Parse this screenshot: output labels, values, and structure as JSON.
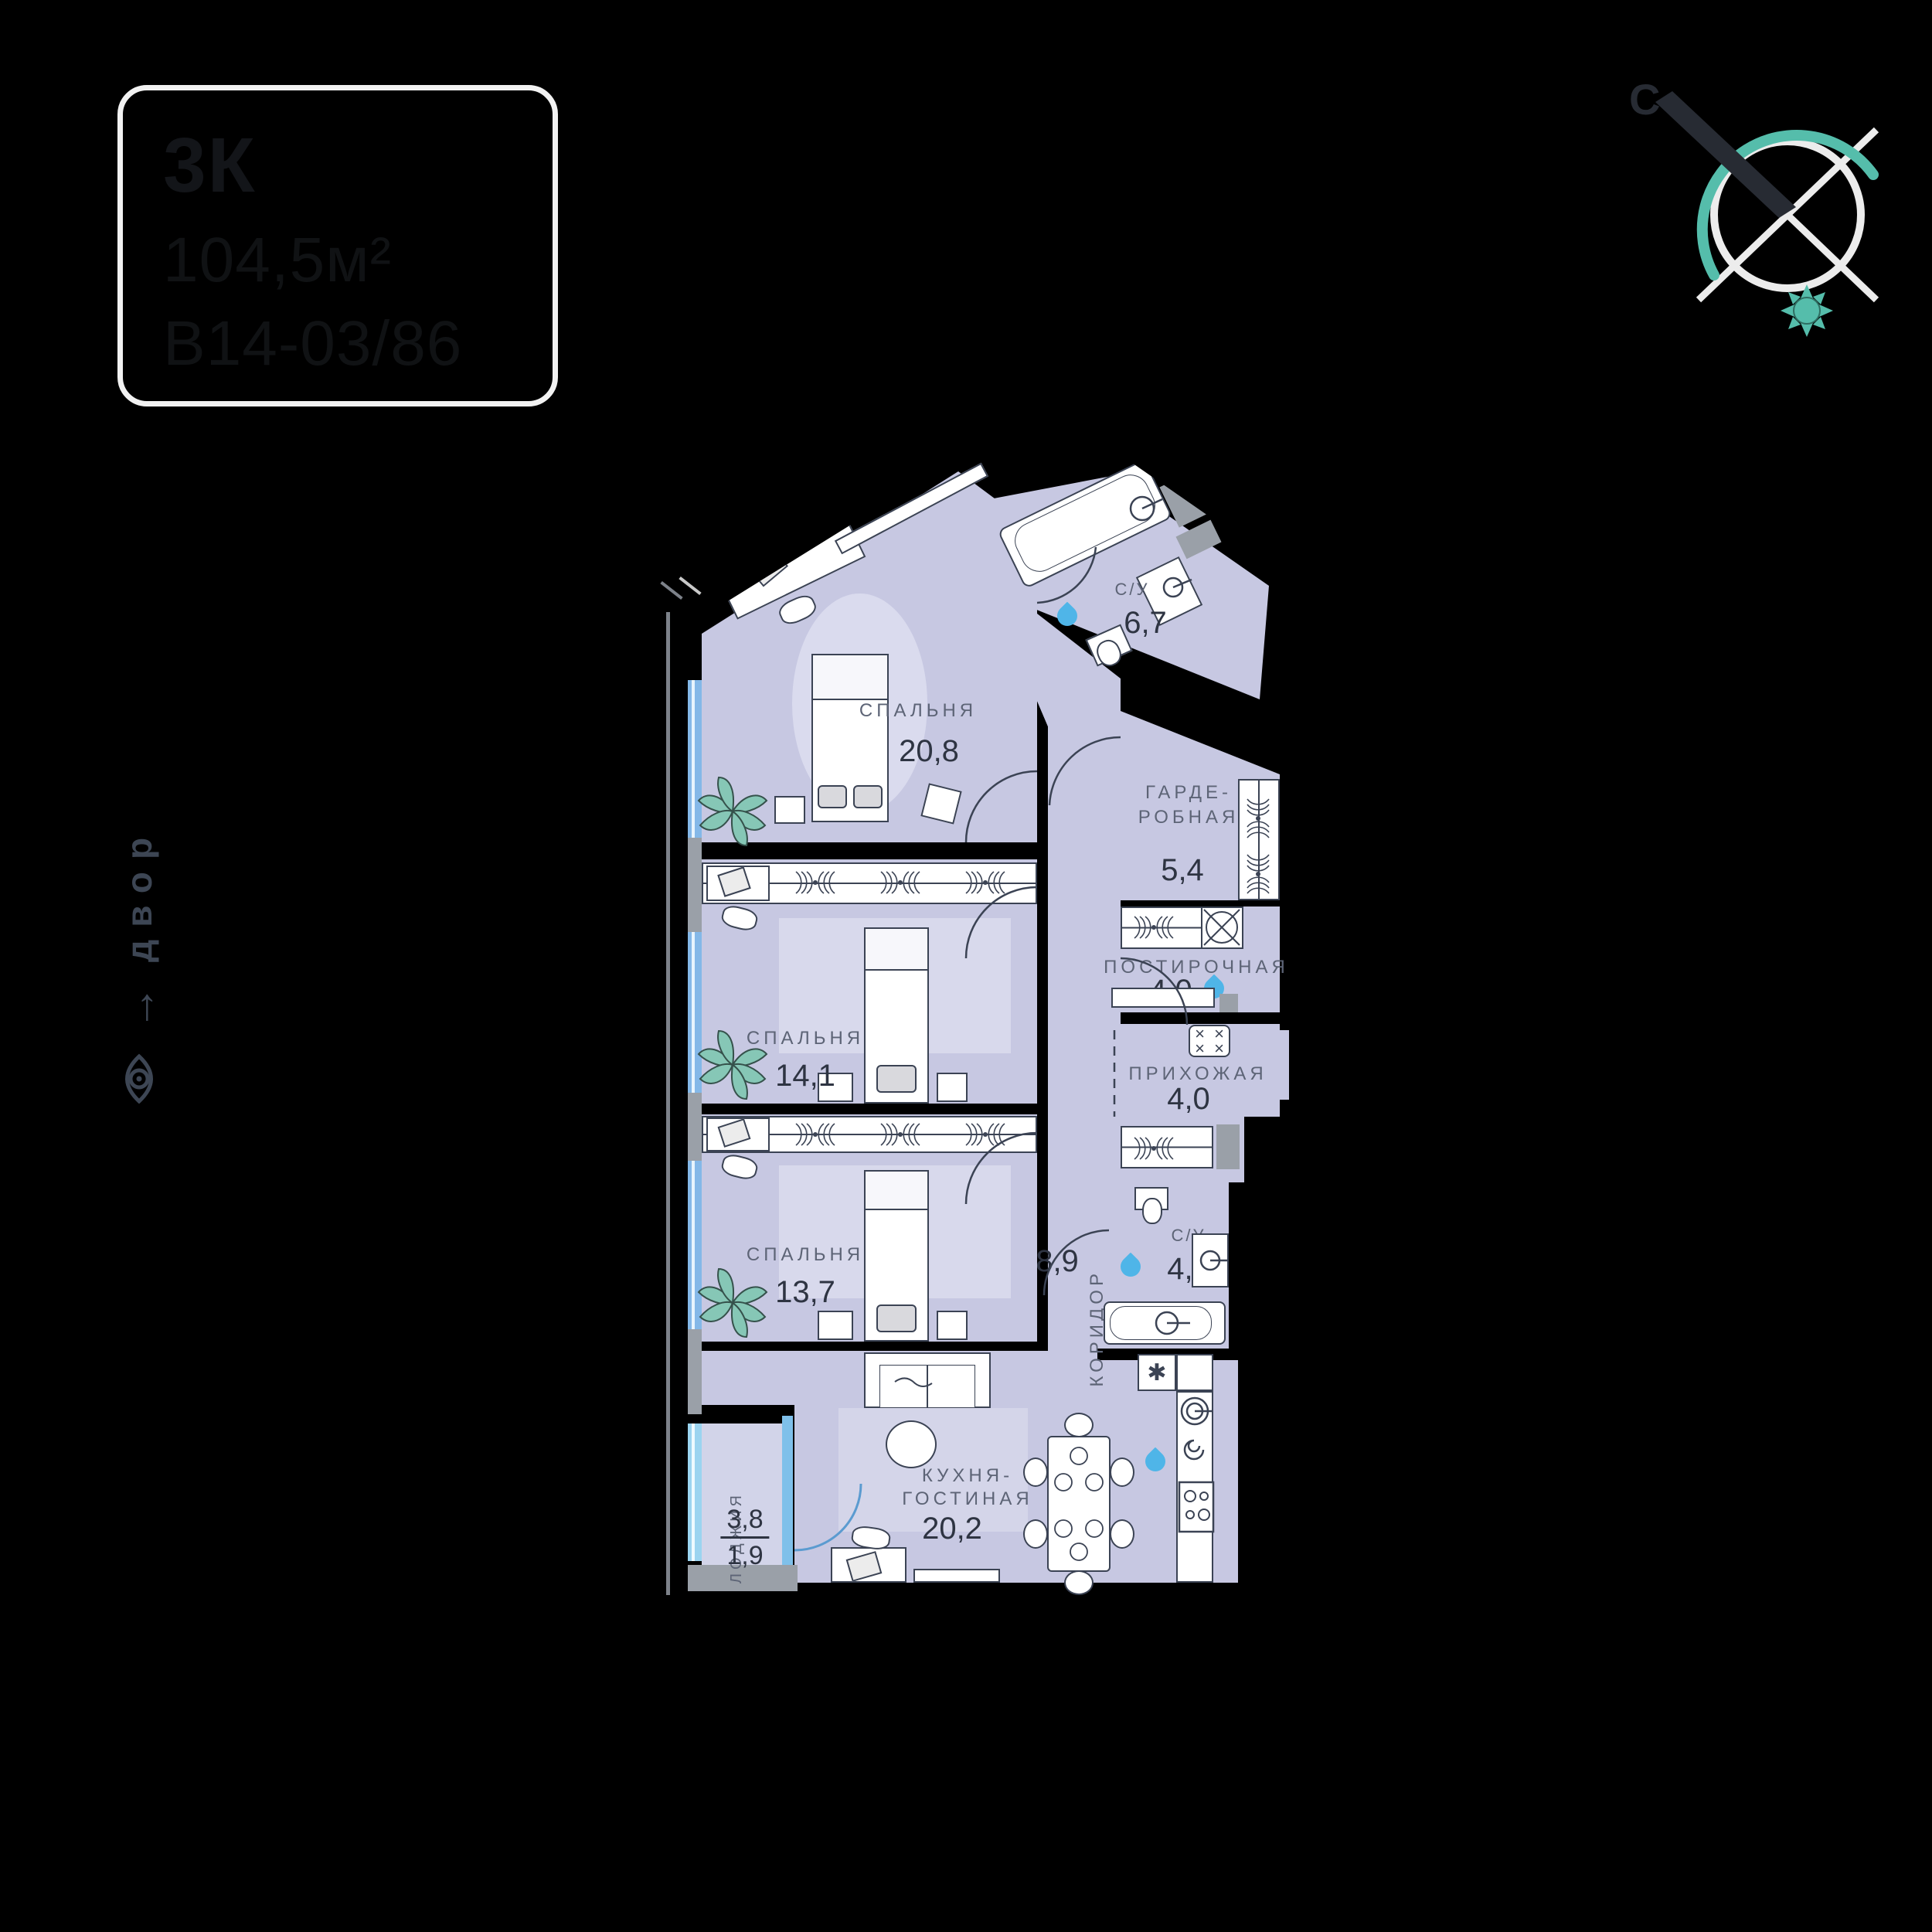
{
  "title_card": {
    "rooms_label": "3К",
    "area": "104,5м²",
    "unit": "В14-03/86"
  },
  "compass": {
    "north_label": "С"
  },
  "site": {
    "courtyard_label": "двор",
    "arrow_glyph": "→"
  },
  "plan": {
    "rooms": {
      "bedroom1": {
        "name": "СПАЛЬНЯ",
        "area": "20,8"
      },
      "bath1": {
        "name": "С/У",
        "area": "6,7"
      },
      "wardrobe": {
        "name_line1": "ГАРДЕ-",
        "name_line2": "РОБНАЯ",
        "area": "5,4"
      },
      "laundry": {
        "name": "ПОСТИРОЧНАЯ",
        "area": "4,0"
      },
      "bedroom2": {
        "name": "СПАЛЬНЯ",
        "area": "14,1"
      },
      "hallway": {
        "name": "ПРИХОЖАЯ",
        "area": "4,0"
      },
      "corridor": {
        "name": "КОРИДОР",
        "area": "8,9"
      },
      "bedroom3": {
        "name": "СПАЛЬНЯ",
        "area": "13,7"
      },
      "bath2": {
        "name": "С/У",
        "area": "4,8"
      },
      "loggia": {
        "name": "ЛОДЖИЯ",
        "area_full": "3,8",
        "area_reduced": "1,9"
      },
      "kitchen": {
        "name_line1": "КУХНЯ-",
        "name_line2": "ГОСТИНАЯ",
        "area": "20,2"
      }
    }
  },
  "colors": {
    "background": "#000000",
    "room_fill": "#c7c8e2",
    "room_fill_light": "#d8d9ec",
    "wall": "#000000",
    "outline": "#3b4354",
    "window_blue": "#84b8e8",
    "accent_teal": "#55bdab",
    "water_drop_blue": "#4fb5e8",
    "shaft_gray": "#9aa0a8",
    "title_border": "#f2f2f2",
    "label_gray": "#5d6476"
  }
}
